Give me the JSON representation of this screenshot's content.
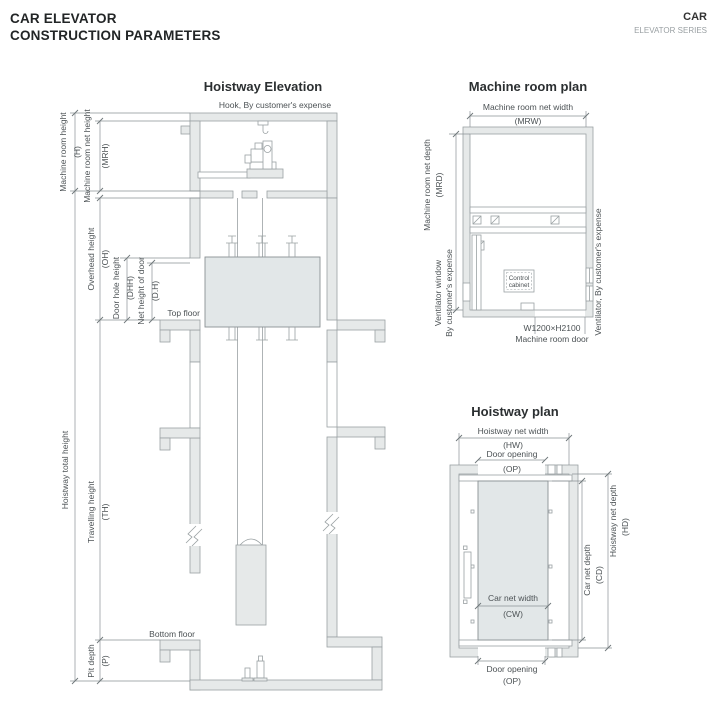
{
  "header": {
    "title_line1": "CAR ELEVATOR",
    "title_line2": "CONSTRUCTION PARAMETERS",
    "brand": "CAR",
    "brand_sub": "ELEVATOR SERIES"
  },
  "elevation": {
    "title": "Hoistway Elevation",
    "hook_note": "Hook, By customer's expense",
    "dims": {
      "h": "Machine room height",
      "h_abbr": "(H)",
      "mrh": "Machine room net height",
      "mrh_abbr": "(MRH)",
      "oh": "Overhead height",
      "oh_abbr": "(OH)",
      "dhh": "Door hole height",
      "dhh_abbr": "(DHH)",
      "dh": "Net height of door",
      "dh_abbr": "(D.H)",
      "hth": "Hoistway total height",
      "th": "Travelling height",
      "th_abbr": "(TH)",
      "p": "Pit depth",
      "p_abbr": "(P)"
    },
    "top_floor": "Top floor",
    "bottom_floor": "Bottom floor"
  },
  "machine_room_plan": {
    "title": "Machine room plan",
    "mrw": "Machine room net width",
    "mrw_abbr": "(MRW)",
    "mrd": "Machine room net depth",
    "mrd_abbr": "(MRD)",
    "vent_window_1": "Ventilator window",
    "vent_window_2": "By customer's expense",
    "vent_right": "Ventilator, By customer's expense",
    "cabinet_1": "Control",
    "cabinet_2": "cabinet",
    "door_size": "W1200×H2100",
    "door_label": "Machine room door"
  },
  "hoistway_plan": {
    "title": "Hoistway plan",
    "hw": "Hoistway net width",
    "hw_abbr": "(HW)",
    "op_top": "Door opening",
    "op_top_abbr": "(OP)",
    "cw": "Car net width",
    "cw_abbr": "(CW)",
    "cd": "Car net depth",
    "cd_abbr": "(CD)",
    "hd": "Hoistway net depth",
    "hd_abbr": "(HD)",
    "op_bottom": "Door opening",
    "op_bottom_abbr": "(OP)"
  },
  "colors": {
    "wall_fill": "#e6e9e9",
    "car_fill": "#e2e7e8",
    "line": "#9aa1a3",
    "dim_line": "#8b9295",
    "text": "#4c5255",
    "title_text": "#2b2f31",
    "muted_text": "#9aa0a3"
  }
}
